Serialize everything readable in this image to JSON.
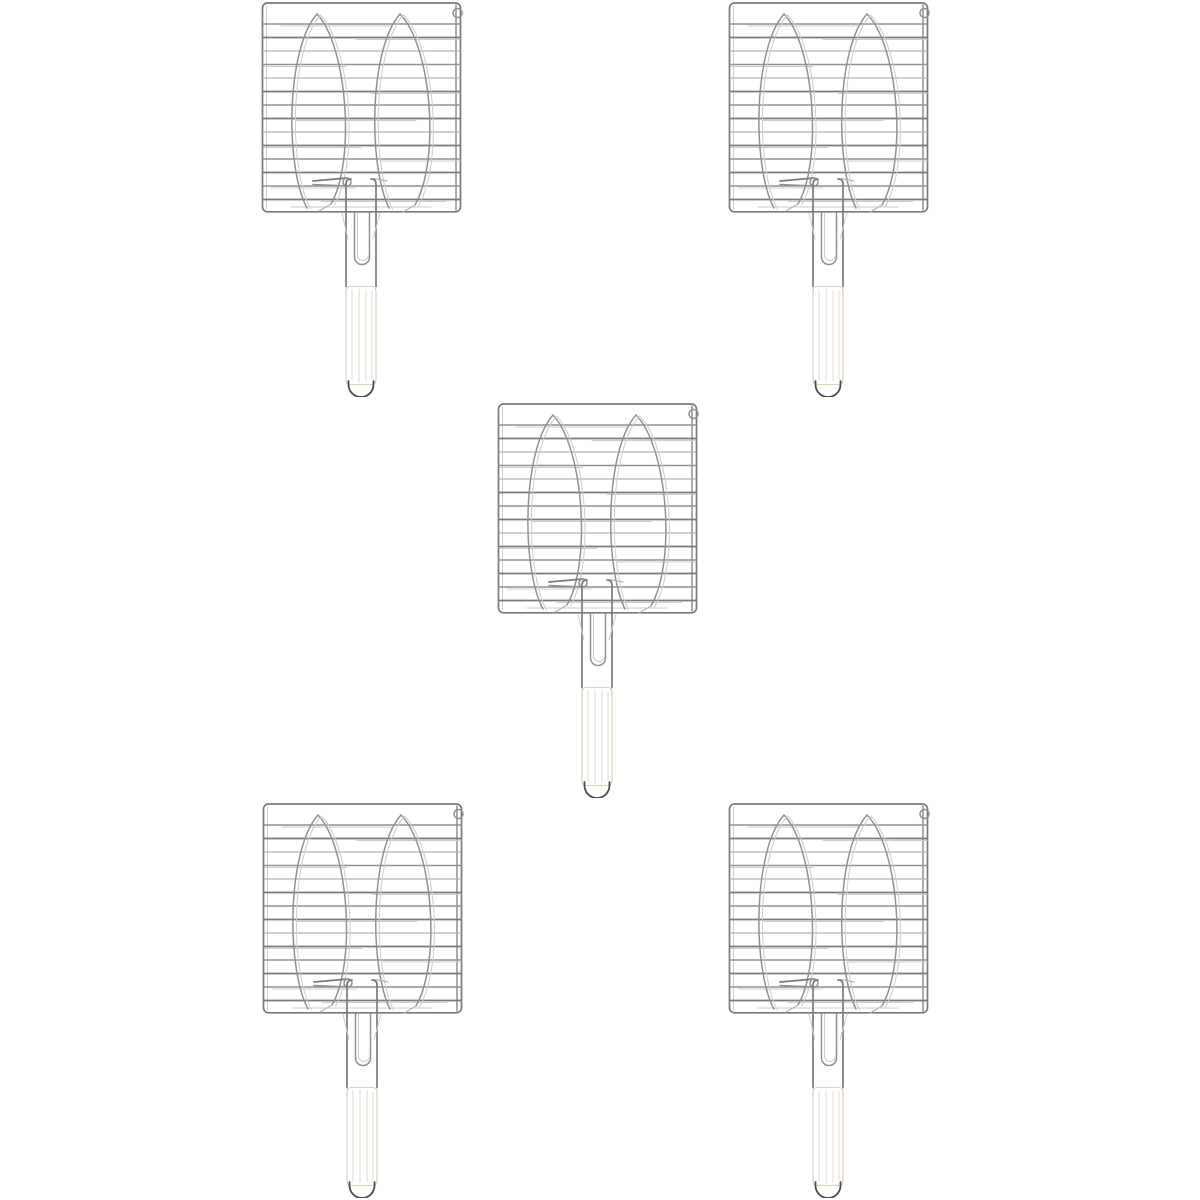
{
  "meta": {
    "description": "Product photo: five identical chrome double-fish barbecue grilling baskets with pale wooden handles arranged in a 2-1-2 pattern on a plain white background",
    "item_count": 5
  },
  "canvas": {
    "width": 1200,
    "height": 1200
  },
  "colors": {
    "background": "#ffffff",
    "wire_dark": "#7a7a7a",
    "wire_mid": "#919191",
    "wire_light": "#b3b3b3",
    "wire_faint": "#cdcdcd",
    "wire_tip": "#4a4a4a",
    "wood_light": "#ead6b6",
    "wood_mid": "#dcc09e",
    "wood_dark": "#cdab84",
    "wood_edge": "#bfa27d",
    "wood_grain": "#a8815a",
    "wood_dot": "#84704f"
  },
  "product": {
    "name": "fish-grill-basket",
    "parts": [
      "square-wire-grid-frame",
      "two-fish-shaped-wire-outlines",
      "hanging-ring-top-right",
      "locking-clip-left-prongs",
      "wire-neck-with-inner-loop",
      "wooden-handle",
      "dark-wire-tip-loop"
    ]
  },
  "items": [
    {
      "id": "grill-basket-top-left",
      "x": 261,
      "y": 1
    },
    {
      "id": "grill-basket-top-right",
      "x": 728,
      "y": 1
    },
    {
      "id": "grill-basket-center",
      "x": 497,
      "y": 402
    },
    {
      "id": "grill-basket-bottom-left",
      "x": 262,
      "y": 802
    },
    {
      "id": "grill-basket-bottom-right",
      "x": 728,
      "y": 802
    }
  ]
}
